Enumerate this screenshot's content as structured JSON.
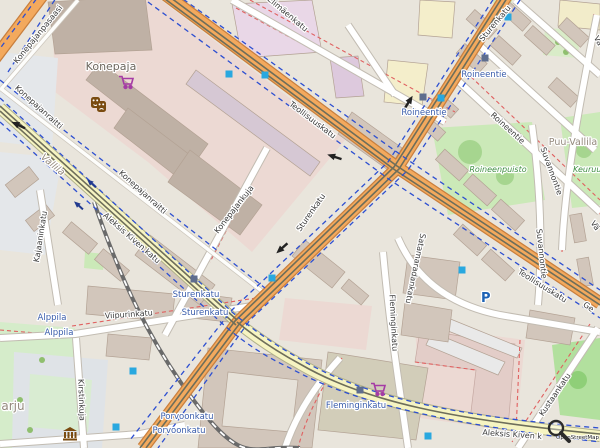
{
  "map": {
    "attribution": "OpenStreetMap",
    "region_labels": [
      {
        "text": "Konepaja"
      },
      {
        "text": "Puu-Vallila"
      },
      {
        "text": "Vallila"
      },
      {
        "text": "arju"
      }
    ],
    "park_labels": [
      {
        "text": "Roineenpuisto"
      },
      {
        "text": "Keuruu"
      }
    ],
    "street_labels": [
      {
        "text": "Elimäenkatu"
      },
      {
        "text": "Teollisuuskatu"
      },
      {
        "text": "Teollisuuskatu"
      },
      {
        "text": "Sturenkatu"
      },
      {
        "text": "Sturenkatu"
      },
      {
        "text": "Roineentie"
      },
      {
        "text": "Suvannontie"
      },
      {
        "text": "Suvannontie"
      },
      {
        "text": "Kustaankatu"
      },
      {
        "text": "Fleminginkatu"
      },
      {
        "text": "Satamaradankatu"
      },
      {
        "text": "Kirstinkuja"
      },
      {
        "text": "Viipurinkatu"
      },
      {
        "text": "Kajaaninkatu"
      },
      {
        "text": "Aleksis Kiven katu"
      },
      {
        "text": "Aleksis Kiven k"
      },
      {
        "text": "Konepajankuja"
      },
      {
        "text": "Konepajanraitti"
      },
      {
        "text": "Konepajanraitti"
      },
      {
        "text": "Konepajanpasaasi"
      },
      {
        "text": "Vä"
      },
      {
        "text": "Vä"
      },
      {
        "text": "Ge"
      }
    ],
    "stop_labels": [
      {
        "text": "Roineentie"
      },
      {
        "text": "Roineentie"
      },
      {
        "text": "Sturenkatu"
      },
      {
        "text": "Sturenkatu"
      },
      {
        "text": "Alppila"
      },
      {
        "text": "Alppila"
      },
      {
        "text": "Porvoonkatu"
      },
      {
        "text": "Porvoonkatu"
      },
      {
        "text": "Fleminginkatu"
      }
    ],
    "poi": {
      "parking_label": "P",
      "icons": [
        {
          "name": "theatre-masks-icon"
        },
        {
          "name": "supermarket-cart-icon"
        },
        {
          "name": "supermarket-cart-icon"
        },
        {
          "name": "museum-icon"
        },
        {
          "name": "parking-icon"
        },
        {
          "name": "magnifier-icon"
        }
      ]
    },
    "colors": {
      "main_road": "#f3a95d",
      "residential_road": "#f6f4c2",
      "minor_road": "#ffffff",
      "cycleway_dash": "#2d4fd1",
      "barrier_dash": "#e06060",
      "park": "#cbe9b8",
      "building": "#d2c6bb",
      "industrial_area": "#ecd9d3",
      "tram_stop_marker": "#29a8df",
      "station_marker": "#5e6d8e",
      "stop_text": "#3a5dab",
      "street_text": "#3b3b3b",
      "park_text": "#3e8e41",
      "region_text": "#94897d",
      "poi_brown": "#7a4b10",
      "poi_purple": "#a53ba5"
    }
  }
}
